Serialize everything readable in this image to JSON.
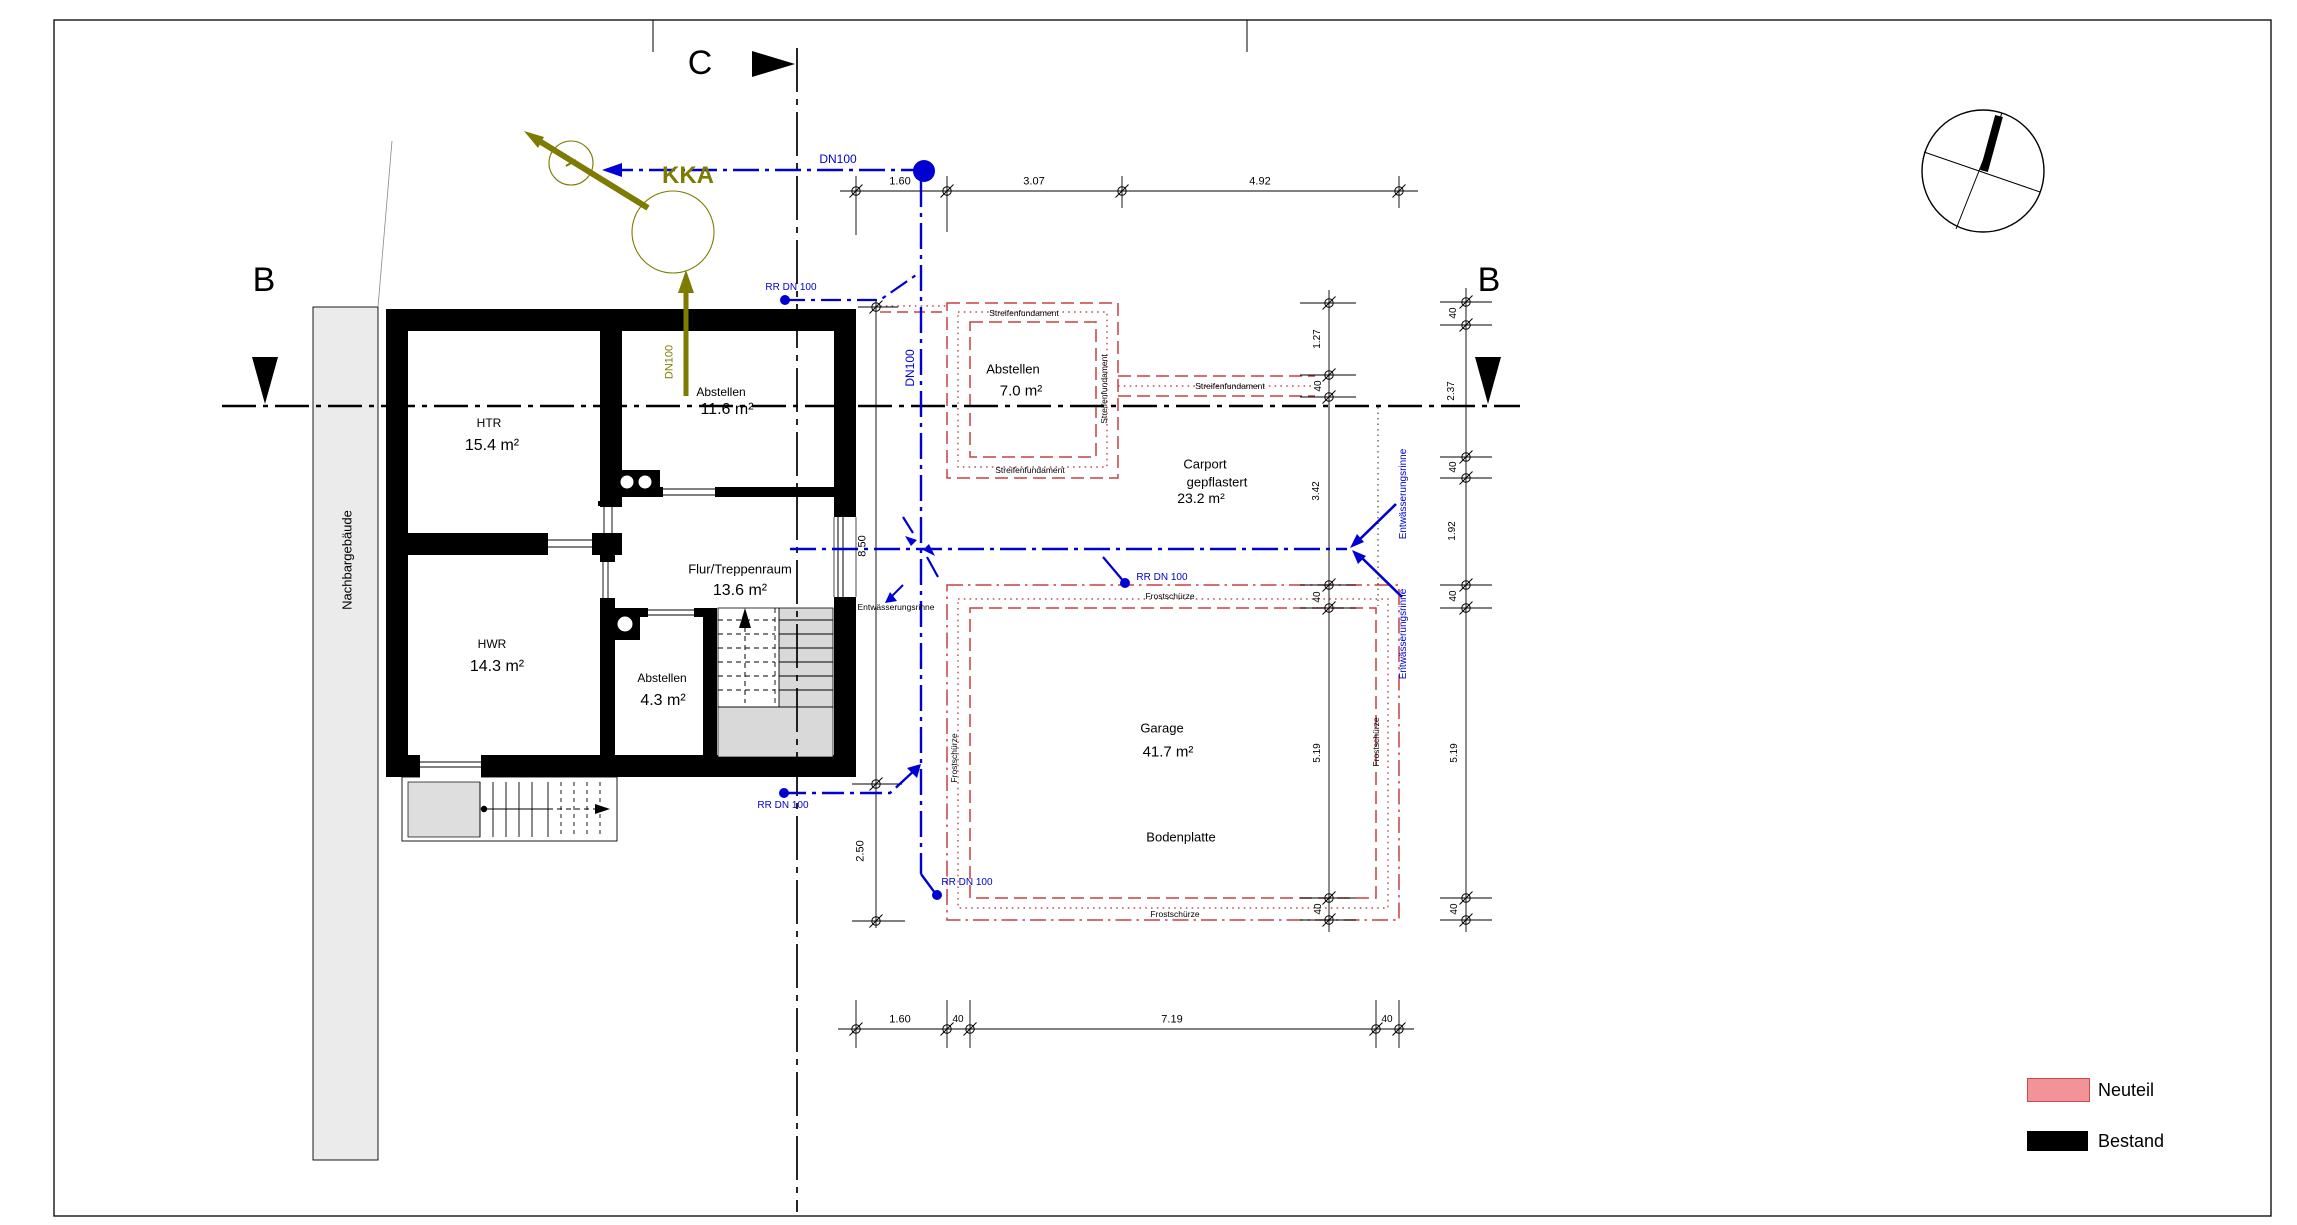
{
  "markers": {
    "section_c": "C",
    "section_b_left": "B",
    "section_b_right": "B"
  },
  "kka": {
    "title": "KKA",
    "pipe_vertical": "DN100"
  },
  "pipes": {
    "dn100": "DN100",
    "rr_dn100": "RR DN 100"
  },
  "site": {
    "neighbor_building": "Nachbargebäude"
  },
  "rooms": {
    "htr": {
      "name": "HTR",
      "area": "15.4 m²"
    },
    "abstellen_og": {
      "name": "Abstellen",
      "area": "11.6 m²"
    },
    "flur": {
      "name": "Flur/Treppenraum",
      "area": "13.6 m²"
    },
    "hwr": {
      "name": "HWR",
      "area": "14.3 m²"
    },
    "abstellen_klein": {
      "name": "Abstellen",
      "area": "4.3 m²"
    },
    "abstellen_neu": {
      "name": "Abstellen",
      "area": "7.0 m²"
    },
    "carport": {
      "name": "Carport",
      "name2": "gepflastert",
      "area": "23.2 m²"
    },
    "garage": {
      "name": "Garage",
      "area": "41.7 m²"
    },
    "bodenplatte": "Bodenplatte"
  },
  "annotations": {
    "streifenfundament": "Streifenfundament",
    "frostschuerze": "Frostschürze",
    "entwaesserungsrinne": "Entwässerungsrinne"
  },
  "dimensions": {
    "top": [
      "1.60",
      "3.07",
      "4.92"
    ],
    "bottom": [
      "1.60",
      "40",
      "7.19",
      "40"
    ],
    "left": [
      "8.50",
      "2.50"
    ],
    "right_inner": [
      "1.27",
      "40",
      "3.42",
      "40",
      "5.19",
      "40"
    ],
    "right_outer": [
      "40",
      "2.37",
      "40",
      "1.92",
      "40",
      "5.19",
      "40"
    ]
  },
  "legend": {
    "neuteil": "Neuteil",
    "bestand": "Bestand"
  },
  "colors": {
    "neuteil_fill": "#F29397",
    "neuteil_border": "#CB4953",
    "bestand": "#000000",
    "pipe_blue": "#0000D2",
    "kka_olive": "#7D7B00",
    "fundament_red": "#C84040"
  }
}
